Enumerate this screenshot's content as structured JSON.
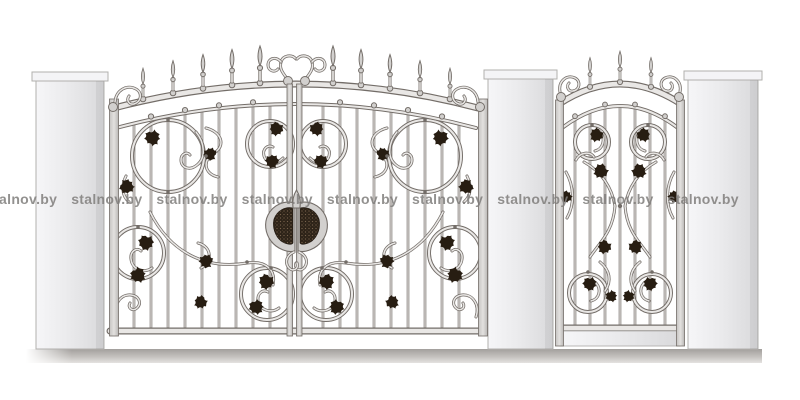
{
  "watermark": {
    "text": "stalnov.by",
    "repeat": 9
  },
  "palette": {
    "background": "#ffffff",
    "line": "#736d68",
    "metal": "#e9e7e5",
    "metal_mid": "#d2d0ce",
    "leaf": "#271d12",
    "medallion_dark": "#2d2318",
    "medallion_fleck": "#77624c",
    "pillar_border": "#b2b0ae",
    "watermark": "#807e7c"
  },
  "scene": {
    "description": "Line drawing of an ornamental wrought-iron double gate and matching wicket gate mounted between three masonry pillars on a ground strip",
    "pillars": 3,
    "double_gate": {
      "leaves": 2,
      "spear_finials": 10,
      "central_scroll": 1,
      "medallion": 1
    },
    "wicket_gate": {
      "spear_finials": 3,
      "bars": 7,
      "kick_panel": 1
    }
  }
}
